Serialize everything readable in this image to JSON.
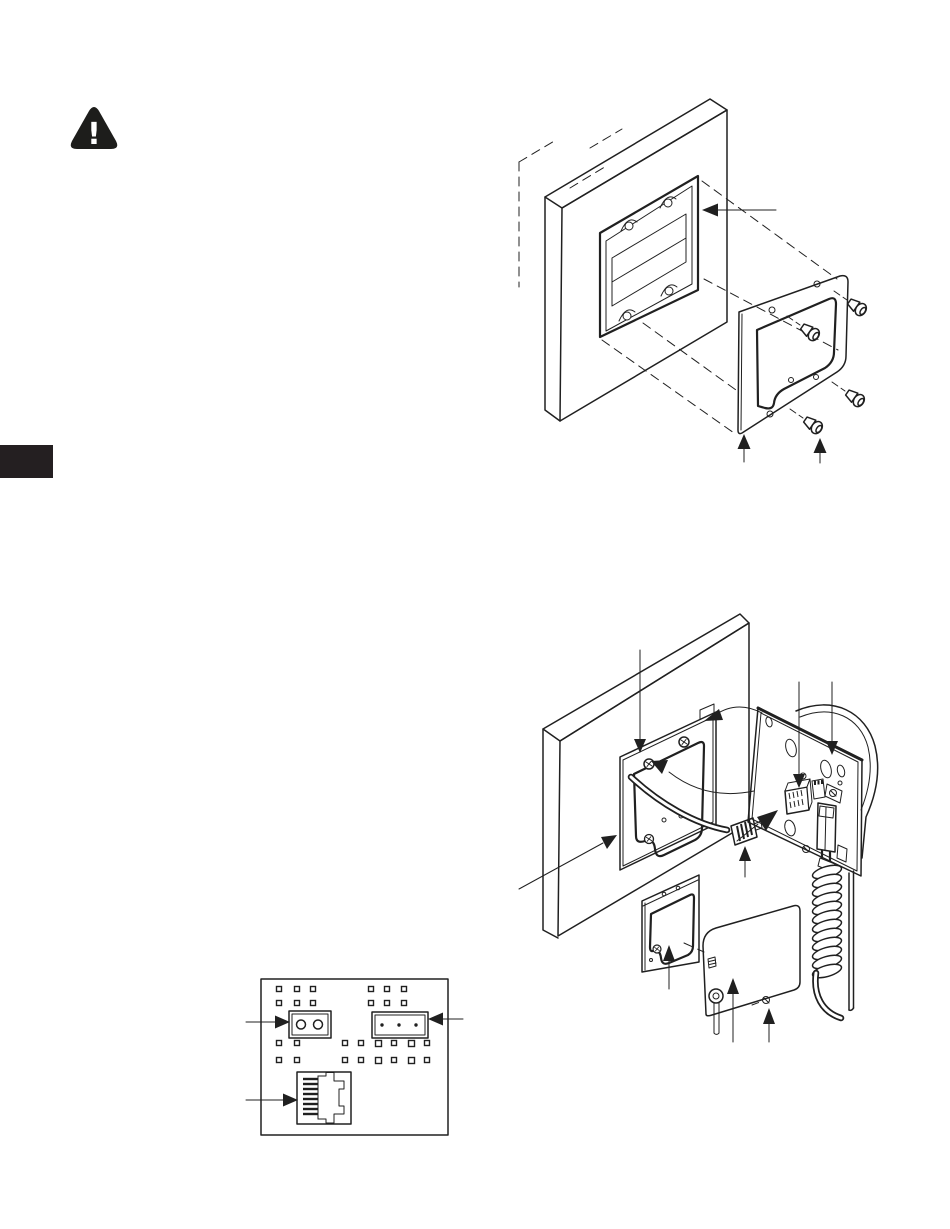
{
  "page": {
    "width": 950,
    "height": 1229,
    "background": "#ffffff",
    "ink_color": "#202020"
  },
  "warning": {
    "icon": "warning-triangle-icon",
    "glyph": "!",
    "color": "#1d1d1b"
  },
  "section_tab": {
    "name": "left-edge-section-tab",
    "color": "#241f21"
  },
  "figures": {
    "figure1": {
      "name": "wall-opening-and-mounting-frame-exploded-view",
      "parts": [
        "wall-with-cutout",
        "recessed-electrical-box",
        "mounting-frame-plate",
        "mounting-screws"
      ],
      "screw_count": 4,
      "arrow_count": 3
    },
    "figure2": {
      "name": "unit-assembly-and-cabling-exploded-view",
      "parts": [
        "wall",
        "adapter-frame",
        "cable-with-modular-plug",
        "unit-rear-panel",
        "rj45-jack",
        "terminal-blocks",
        "coiled-handset-cord",
        "trim-bezel",
        "cover-plate-with-pull-knob"
      ],
      "arrow_count": 11
    },
    "figure3": {
      "name": "pcb-connector-location-detail",
      "parts": [
        "circuit-board",
        "2-position-connector",
        "3-position-connector",
        "rj45-jack-footprint"
      ],
      "arrow_count": 3
    }
  }
}
